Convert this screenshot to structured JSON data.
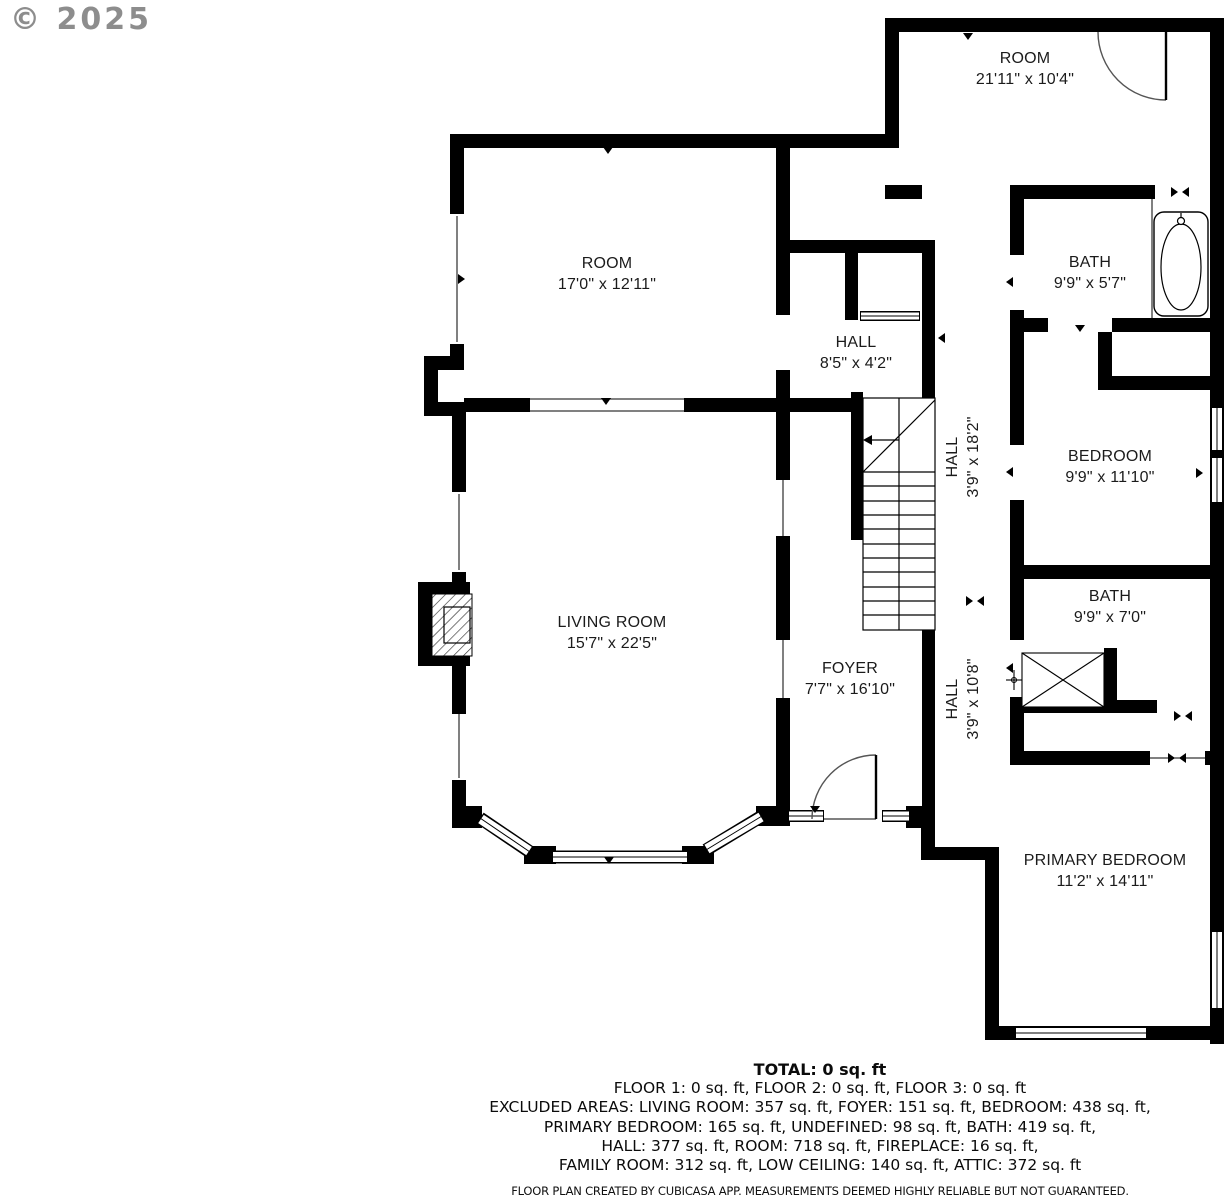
{
  "watermark": "© 2025",
  "rooms": [
    {
      "name": "ROOM",
      "dims": "21'11\" x 10'4\""
    },
    {
      "name": "ROOM",
      "dims": "17'0\" x 12'11\""
    },
    {
      "name": "BATH",
      "dims": "9'9\" x 5'7\""
    },
    {
      "name": "HALL",
      "dims": "8'5\" x 4'2\""
    },
    {
      "name": "HALL",
      "dims": "3'9\" x 18'2\""
    },
    {
      "name": "BEDROOM",
      "dims": "9'9\" x 11'10\""
    },
    {
      "name": "LIVING ROOM",
      "dims": "15'7\" x 22'5\""
    },
    {
      "name": "BATH",
      "dims": "9'9\" x 7'0\""
    },
    {
      "name": "FOYER",
      "dims": "7'7\" x 16'10\""
    },
    {
      "name": "HALL",
      "dims": "3'9\" x 10'8\""
    },
    {
      "name": "PRIMARY BEDROOM",
      "dims": "11'2\" x 14'11\""
    }
  ],
  "summary": {
    "total": "TOTAL: 0 sq. ft",
    "floors": "FLOOR 1: 0 sq. ft, FLOOR 2: 0 sq. ft, FLOOR 3: 0 sq. ft",
    "excluded_1": "EXCLUDED AREAS: LIVING ROOM: 357 sq. ft, FOYER: 151 sq. ft, BEDROOM: 438 sq. ft,",
    "excluded_2": "PRIMARY BEDROOM: 165 sq. ft, UNDEFINED: 98 sq. ft, BATH: 419 sq. ft,",
    "excluded_3": "HALL: 377 sq. ft, ROOM: 718 sq. ft, FIREPLACE: 16 sq. ft,",
    "excluded_4": "FAMILY ROOM: 312 sq. ft, LOW CEILING: 140 sq. ft, ATTIC: 372 sq. ft"
  },
  "footer": "FLOOR PLAN CREATED BY CUBICASA APP. MEASUREMENTS DEEMED HIGHLY RELIABLE BUT NOT GUARANTEED.",
  "colors": {
    "wall": "#000000",
    "background": "#ffffff",
    "watermark": "#8d8d8d"
  }
}
